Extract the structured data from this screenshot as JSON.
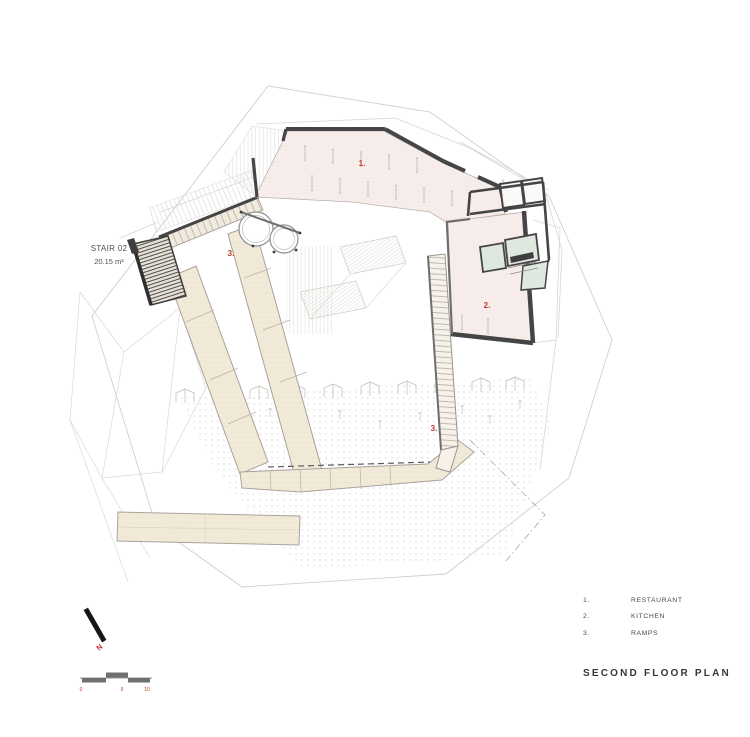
{
  "page": {
    "title": "SECOND FLOOR PLAN"
  },
  "annotations": {
    "stair": {
      "name": "STAIR 02",
      "area": "20.15 m²"
    },
    "room_labels": {
      "restaurant": "1.",
      "kitchen": "2.",
      "ramp_upper": "3.",
      "ramp_lower": "3."
    }
  },
  "legend": {
    "items": [
      {
        "number": "1.",
        "label": "RESTAURANT"
      },
      {
        "number": "2.",
        "label": "KITCHEN"
      },
      {
        "number": "3.",
        "label": "RAMPS"
      }
    ]
  },
  "compass": {
    "label": "N"
  },
  "scale_bar": {
    "ticks": [
      "0",
      "5",
      "10"
    ]
  },
  "colors": {
    "floor_pink": "#f8efec",
    "floor_beige": "#f2ead9",
    "room_green": "#dfe8df",
    "wall_dark": "#454545",
    "label_red": "#bf392c",
    "text_dark": "#373737",
    "faint_line": "#d5d2cd"
  }
}
